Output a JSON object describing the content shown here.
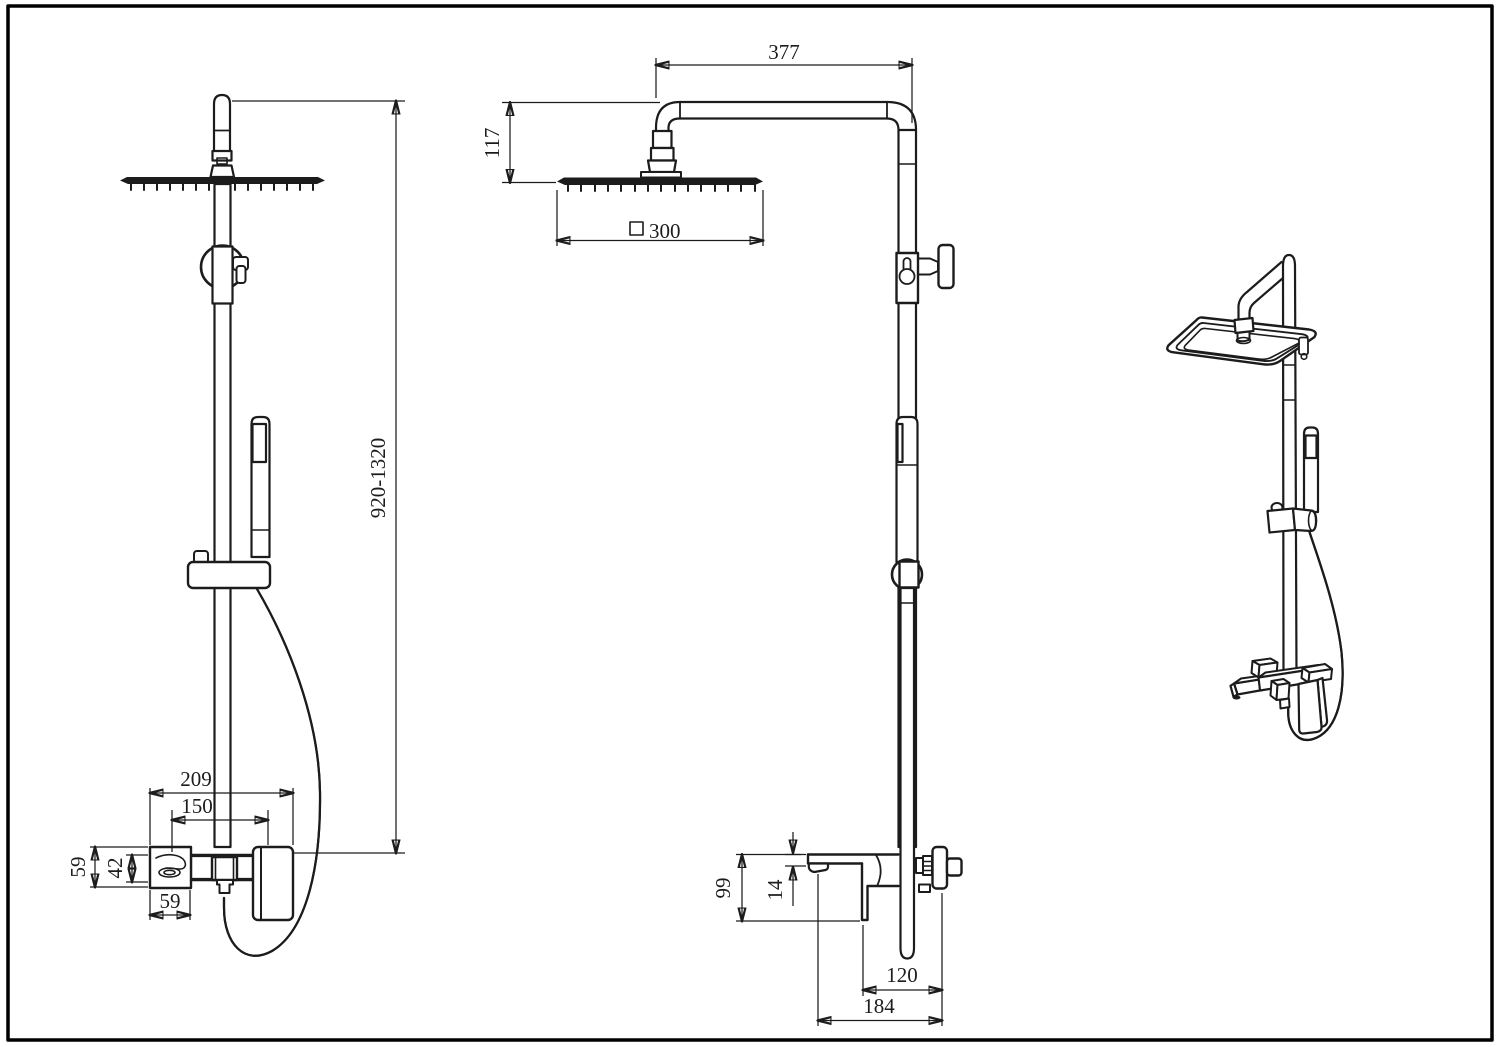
{
  "drawing": {
    "background": "#ffffff",
    "line_color": "#1c1c1c",
    "sheet_frame_color": "#000000",
    "views": {
      "side_view": {
        "dims": {
          "overall_height": "920-1320",
          "faucet_overall_width": "209",
          "spout_to_handle_spacing": "150",
          "faucet_body_height": "59",
          "faucet_inner_height": "42",
          "spout_section_width": "59"
        }
      },
      "front_view": {
        "dims": {
          "arm_reach": "377",
          "arm_drop_height": "117",
          "head_size_symbol": "□",
          "head_size": "300",
          "faucet_height": "99",
          "spout_drop": "14",
          "hand_shower_offset": "120",
          "overall_depth": "184"
        }
      }
    }
  }
}
